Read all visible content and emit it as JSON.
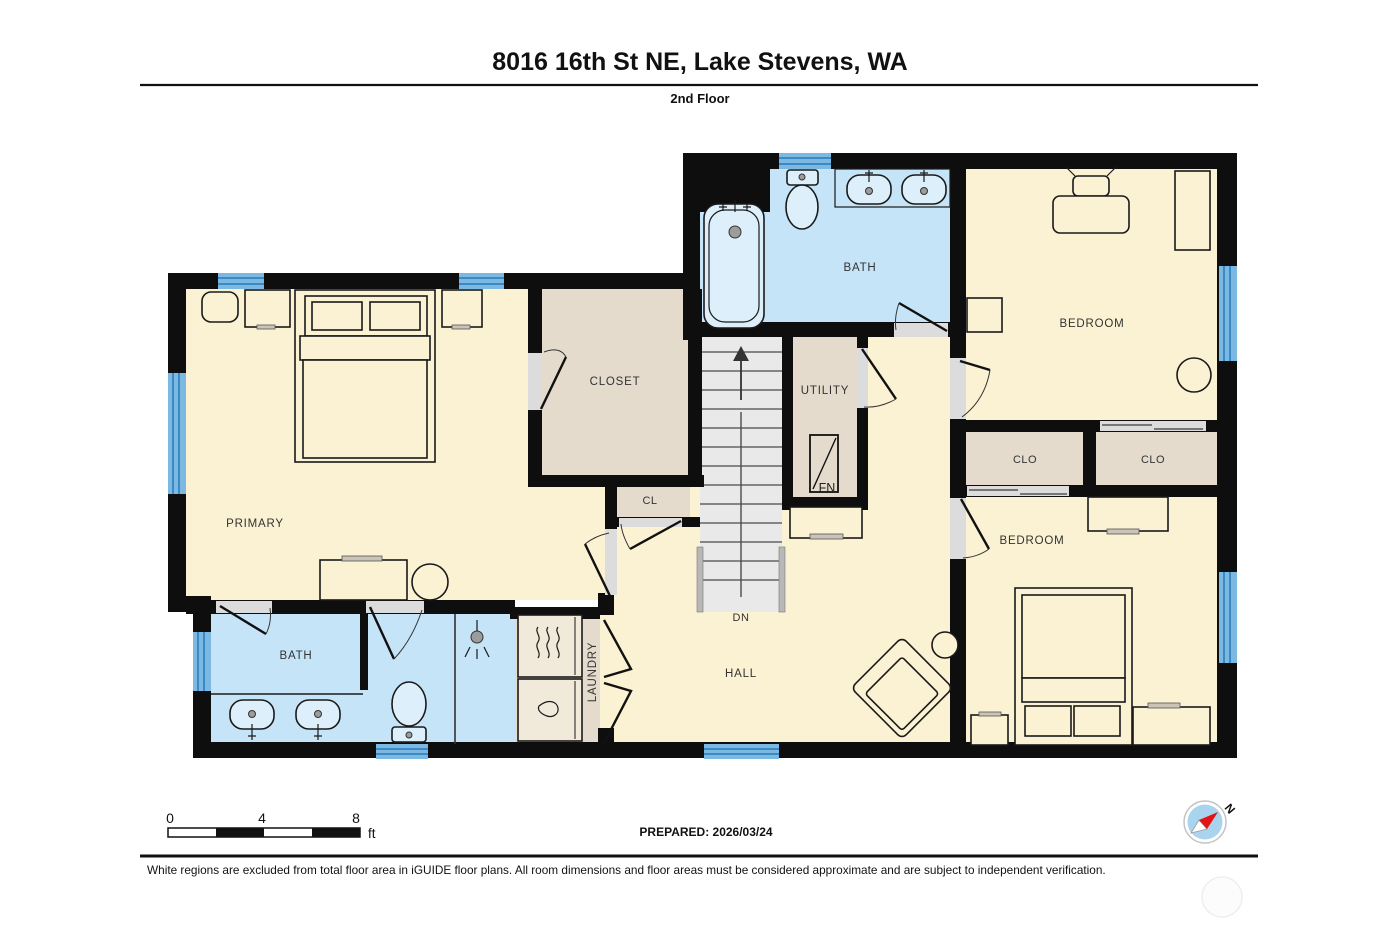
{
  "header": {
    "title": "8016 16th St NE, Lake Stevens, WA",
    "floor_label": "2nd Floor"
  },
  "rooms": {
    "primary": "PRIMARY",
    "closet": "CLOSET",
    "cl": "CL",
    "utility": "UTILITY",
    "furnace": "FN",
    "bath_upper": "BATH",
    "bath_lower": "BATH",
    "bedroom_upper": "BEDROOM",
    "bedroom_lower": "BEDROOM",
    "clo_left": "CLO",
    "clo_right": "CLO",
    "hall": "HALL",
    "laundry": "LAUNDRY",
    "stairs_down": "DN"
  },
  "scale_bar": {
    "tick_0": "0",
    "tick_4": "4",
    "tick_8": "8",
    "unit": "ft"
  },
  "footer": {
    "prepared": "PREPARED: 2026/03/24",
    "disclaimer": "White regions are excluded from total floor area in iGUIDE floor plans. All room dimensions and floor areas must be considered approximate and are subject to independent verification.",
    "compass_north": "N"
  },
  "colors": {
    "wall": "#0e0e0e",
    "room_cream": "#FBF1D3",
    "room_tan": "#E4DBCD",
    "room_blue": "#C6E4F8",
    "fixture_blue": "#DCEFFB",
    "laundry_box": "#F1E9DA",
    "stairs": "#E9E9E9",
    "stair_rail": "#B8B8B8",
    "window_blue": "#7BB9E2",
    "window_stripe": "#3D89C4",
    "door_gap": "#DCDCDC",
    "outline": "#1a1a1a",
    "compass_blue": "#A9D4EE",
    "compass_red": "#E51414",
    "label": "#333333"
  }
}
